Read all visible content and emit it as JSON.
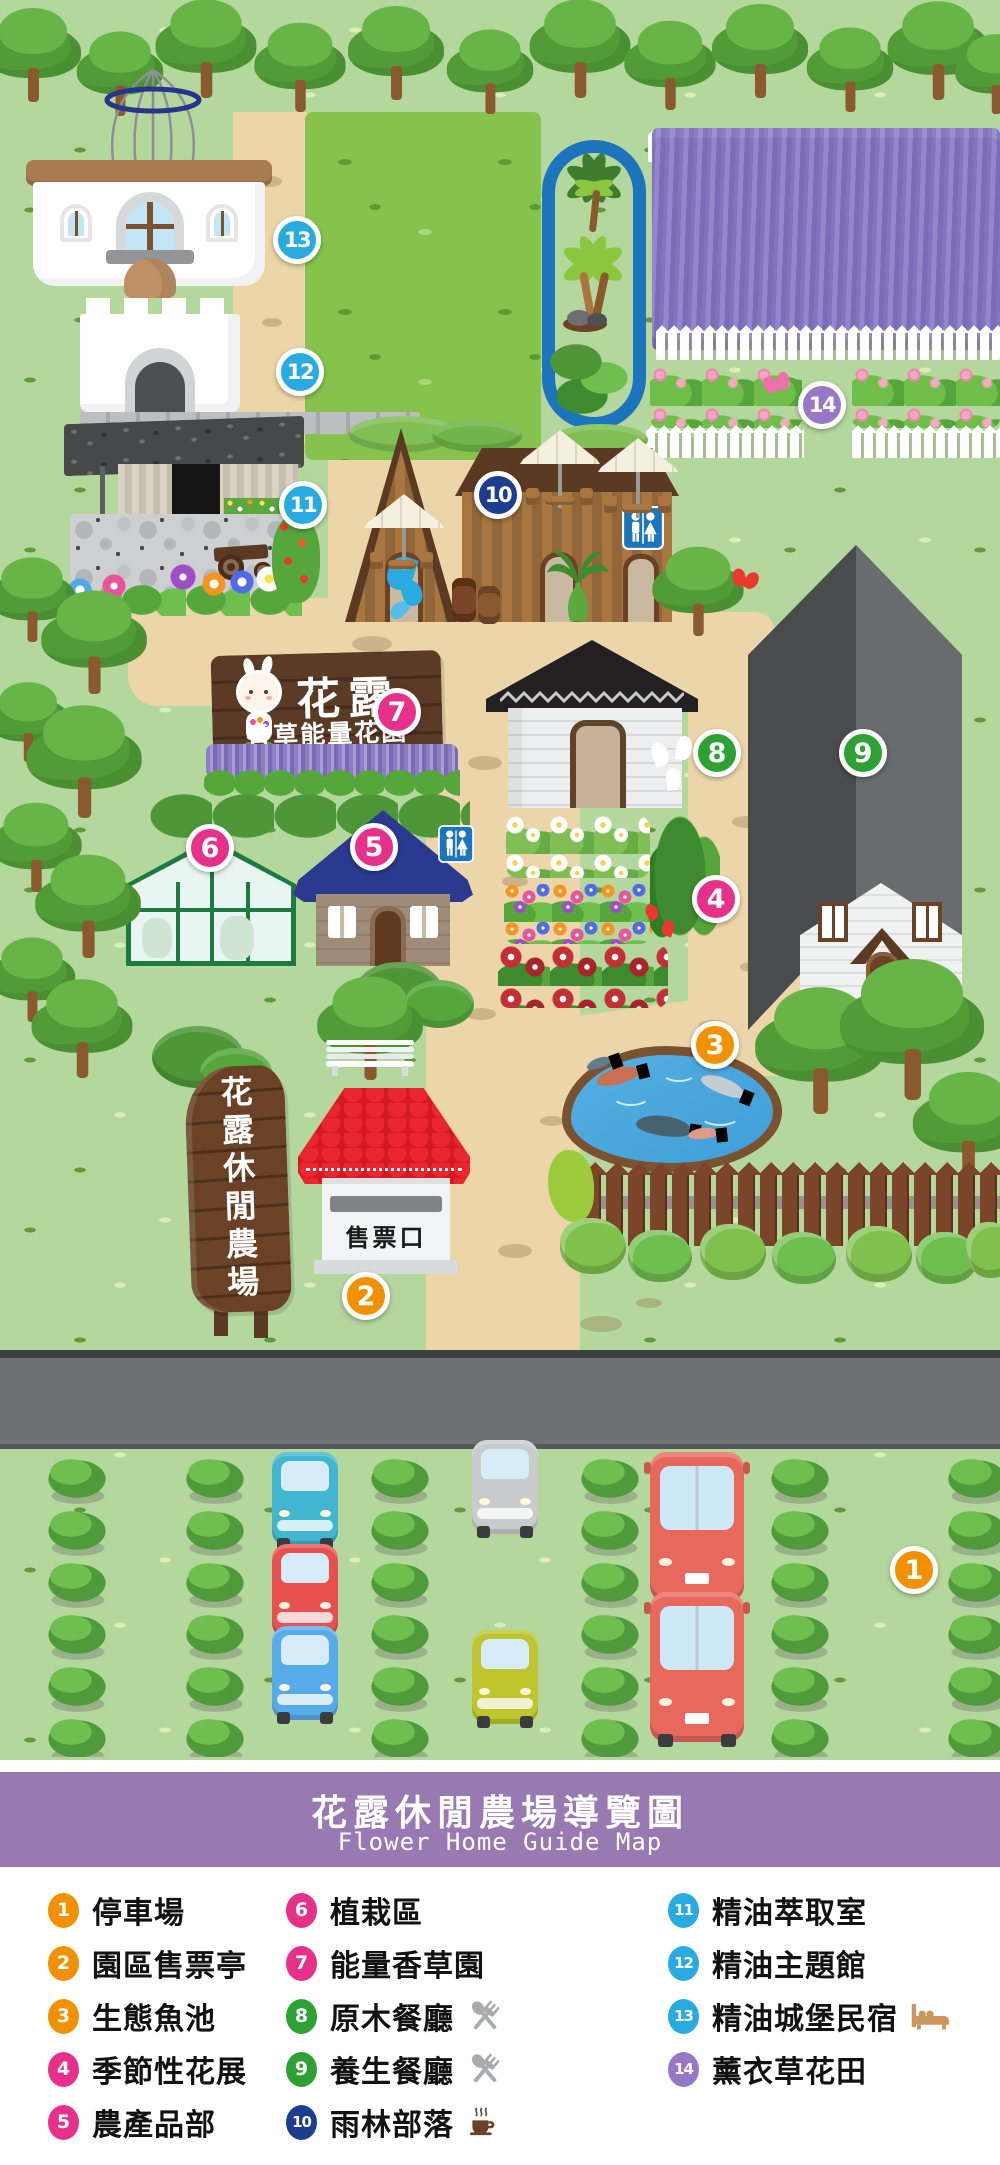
{
  "banner": {
    "title": "花露休閒農場導覽圖",
    "subtitle": "Flower Home Guide Map"
  },
  "map": {
    "markers": [
      {
        "num": "1",
        "color": "#F29100"
      },
      {
        "num": "2",
        "color": "#F29100"
      },
      {
        "num": "3",
        "color": "#F29100"
      },
      {
        "num": "4",
        "color": "#E73089"
      },
      {
        "num": "5",
        "color": "#E73089"
      },
      {
        "num": "6",
        "color": "#E73089"
      },
      {
        "num": "7",
        "color": "#E73089"
      },
      {
        "num": "8",
        "color": "#2EA135"
      },
      {
        "num": "9",
        "color": "#2EA135"
      },
      {
        "num": "10",
        "color": "#1D3D8F"
      },
      {
        "num": "11",
        "color": "#29ABE2"
      },
      {
        "num": "12",
        "color": "#29ABE2"
      },
      {
        "num": "13",
        "color": "#29ABE2"
      },
      {
        "num": "14",
        "color": "#9878C6"
      }
    ],
    "signs": {
      "brand": "花露",
      "brand_sub": "香草能量花園",
      "farm": "花露休閒農場",
      "ticket": "售票口"
    }
  },
  "legend": {
    "items": [
      {
        "num": "1",
        "label": "停車場",
        "color": "#F29100"
      },
      {
        "num": "2",
        "label": "園區售票亭",
        "color": "#F29100"
      },
      {
        "num": "3",
        "label": "生態魚池",
        "color": "#F29100"
      },
      {
        "num": "4",
        "label": "季節性花展",
        "color": "#E73089"
      },
      {
        "num": "5",
        "label": "農產品部",
        "color": "#E73089"
      },
      {
        "num": "6",
        "label": "植栽區",
        "color": "#E73089"
      },
      {
        "num": "7",
        "label": "能量香草園",
        "color": "#E73089"
      },
      {
        "num": "8",
        "label": "原木餐廳",
        "color": "#2EA135",
        "icon": "fork-and-spoon"
      },
      {
        "num": "9",
        "label": "養生餐廳",
        "color": "#2EA135",
        "icon": "fork-and-spoon"
      },
      {
        "num": "10",
        "label": "雨林部落",
        "color": "#1D3D8F",
        "icon": "coffee-cup"
      },
      {
        "num": "11",
        "label": "精油萃取室",
        "color": "#29ABE2"
      },
      {
        "num": "12",
        "label": "精油主題館",
        "color": "#29ABE2"
      },
      {
        "num": "13",
        "label": "精油城堡民宿",
        "color": "#29ABE2",
        "icon": "bed"
      },
      {
        "num": "14",
        "label": "薰衣草花田",
        "color": "#9878C6"
      }
    ]
  },
  "palette": {
    "grass": "#B4D79D",
    "field": "#85C34D",
    "path": "#EBD5A9",
    "road": "#6F7073",
    "banner": "#9879B2",
    "lavender": "#8E7FC5",
    "pond": "#49A4DD"
  }
}
